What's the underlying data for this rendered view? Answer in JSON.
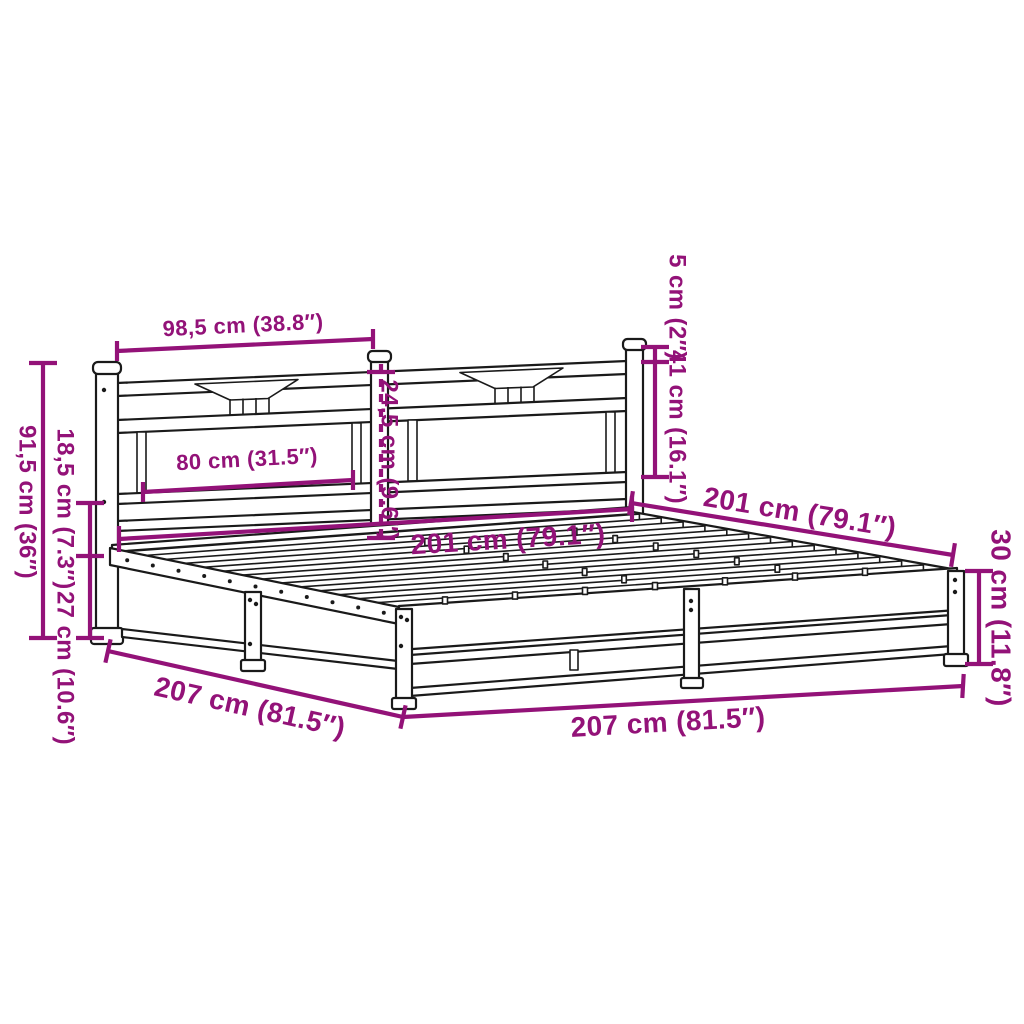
{
  "diagram": {
    "subject": "metal bed frame with headboard",
    "background_color": "#ffffff",
    "line_color": "#1a1a1a",
    "dimension_color": "#931278"
  },
  "labels": {
    "headboard_section_width": "98,5 cm (38.8″)",
    "headboard_panel_width": "80 cm (31.5″)",
    "headboard_drop": "24,5 cm (9.6″)",
    "post_above_rail": "5 cm (2″)",
    "headboard_above_frame": "41 cm (16.1″)",
    "headboard_total_height": "91,5 cm (36″)",
    "side_upper_height": "18,5 cm (7.3″)",
    "side_lower_height": "27 cm (10.6″)",
    "inner_width": "201 cm (79.1″)",
    "inner_length": "201 cm (79.1″)",
    "outer_length": "207 cm (81.5″)",
    "outer_width": "207 cm (81.5″)",
    "frame_height": "30 cm (11.8″)"
  }
}
